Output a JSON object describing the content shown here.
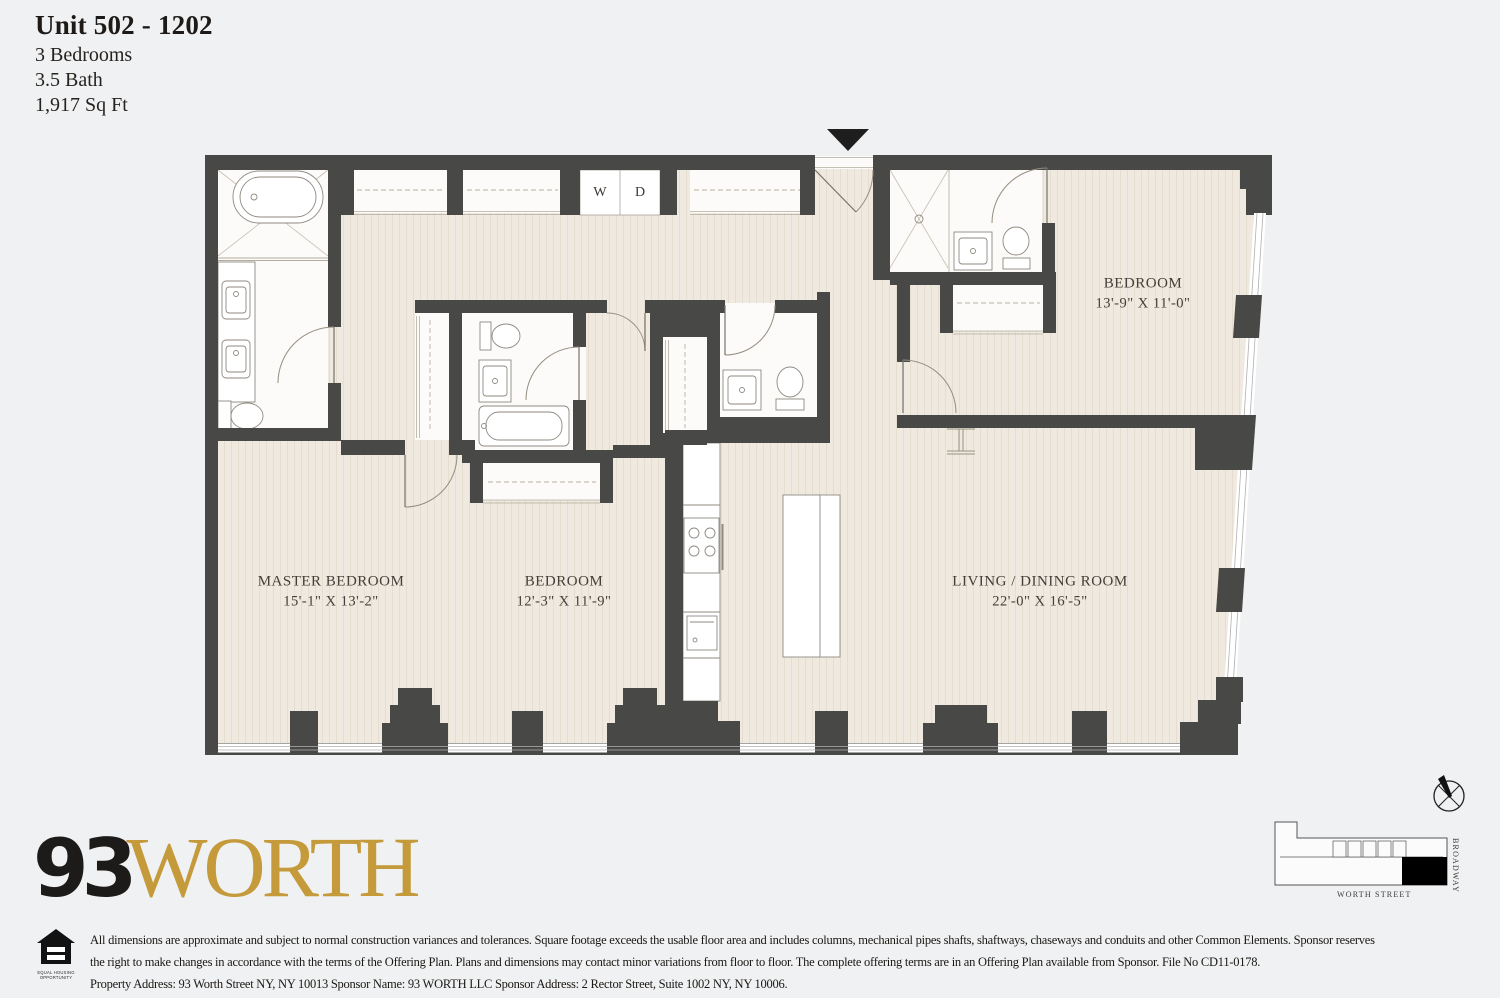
{
  "header": {
    "title": "Unit 502 - 1202",
    "specs": [
      "3 Bedrooms",
      "3.5 Bath",
      "1,917 Sq Ft"
    ]
  },
  "plan": {
    "rooms": {
      "master_bedroom": {
        "name": "MASTER BEDROOM",
        "dims": "15'-1\" X 13'-2\""
      },
      "bedroom_2": {
        "name": "BEDROOM",
        "dims": "12'-3\" X 11'-9\""
      },
      "bedroom_3": {
        "name": "BEDROOM",
        "dims": "13'-9\" X 11'-0\""
      },
      "living_dining": {
        "name": "LIVING / DINING ROOM",
        "dims": "22'-0\" X 16'-5\""
      }
    },
    "appliances": {
      "washer": "W",
      "dryer": "D"
    }
  },
  "branding": {
    "logo_number": "93",
    "logo_name": "WORTH",
    "gold_color": "#c49a3b",
    "wall_color": "#484846",
    "floor_color": "#efe9df"
  },
  "site_plan": {
    "street_bottom": "WORTH STREET",
    "street_right": "BROADWAY"
  },
  "equal_housing": {
    "label": "EQUAL HOUSING OPPORTUNITY"
  },
  "disclaimer": {
    "lines": [
      "All dimensions are approximate and subject to normal construction variances and tolerances. Square footage exceeds the usable floor area and includes columns, mechanical pipes shafts, shaftways, chaseways and conduits and other Common Elements. Sponsor reserves",
      "the right to make changes in accordance with the terms of the Offering Plan. Plans and dimensions may contact minor variations from floor to floor. The complete offering terms are in an Offering Plan available from Sponsor. File No CD11-0178.",
      "Property Address: 93 Worth Street NY, NY 10013 Sponsor Name: 93 WORTH LLC Sponsor Address: 2 Rector Street, Suite 1002 NY, NY 10006."
    ]
  }
}
